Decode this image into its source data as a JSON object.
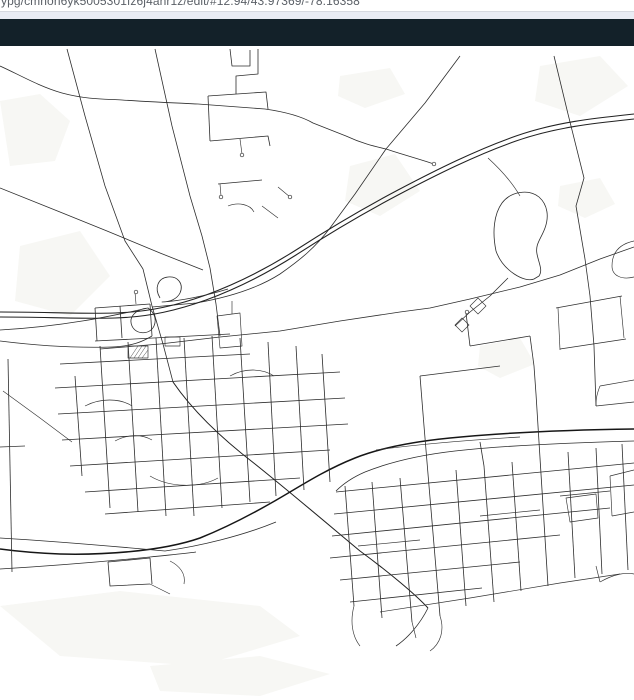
{
  "browser": {
    "url_text": "ypg/cmnon6yk5005301fz6j4ahr1z/edit/#12.94/43.97369/-78.16358"
  },
  "header": {
    "note": "empty dark toolbar"
  },
  "map": {
    "view": {
      "zoom": "12.94",
      "lat": "43.97369",
      "lng": "-78.16358"
    },
    "colors": {
      "background": "#ffffff",
      "patch": "#f7f7f4",
      "road": "#2d2d2d",
      "road_major": "#222222",
      "road_minor": "#333333",
      "railway": "#161616",
      "header_bg": "#132129",
      "chrome_strip": "#e9ecf4",
      "chrome_border": "#d6d9e0",
      "url_text_color": "#5b6067"
    },
    "patches": [
      "M0 55 L40 48 L70 75 L55 115 L10 120 Z",
      "M540 20 L600 10 L628 40 L580 70 L535 55 Z",
      "M20 200 L80 185 L110 230 L70 270 L15 255 Z",
      "M350 120 L395 108 L420 145 L380 170 L345 155 Z",
      "M0 560 L120 545 L260 560 L300 590 L200 620 L60 610 Z",
      "M480 300 L520 292 L535 318 L500 332 L478 320 Z",
      "M560 140 L600 132 L615 158 L585 172 L558 160 Z",
      "M150 620 L260 610 L330 628 L260 650 L160 645 Z",
      "M340 30 L390 22 L405 48 L365 62 L338 50 Z"
    ],
    "features": [
      {
        "name": "rural-road-north-a",
        "cls": "road",
        "d": "M67 3 L85 70 L105 140 L125 195 L143 223"
      },
      {
        "name": "burnham-through-interchange",
        "cls": "road",
        "d": "M143 223 L152 260 L163 298 L173 336"
      },
      {
        "name": "sweep-road-southeast",
        "cls": "major",
        "d": "M173 336 C195 368 225 395 255 418 C290 446 330 480 360 505 C390 527 416 549 428 562"
      },
      {
        "name": "rural-road-north-b",
        "cls": "road",
        "d": "M155 3 L172 80 L190 150 L202 190 L210 222"
      },
      {
        "name": "division-connector",
        "cls": "road",
        "d": "M210 222 L216 258 L220 290"
      },
      {
        "name": "top-curvy-road",
        "cls": "road",
        "d": "M0 20 C18 28 38 40 62 47 C88 54 108 53 122 54 C152 56 176 57 198 58 L265 63 C286 66 301 70 313 77 L346 90 C361 97 373 100 386 103"
      },
      {
        "name": "top-road-east-stub",
        "cls": "road",
        "d": "M386 103 C401 108 419 113 434 118"
      },
      {
        "name": "northeast-diagonal",
        "cls": "road",
        "d": "M460 10 L425 57 L386 103 L355 148 L330 182 C315 202 300 214 280 228 C255 244 225 252 196 257 L152 261"
      },
      {
        "name": "northwest-diagonal",
        "cls": "road",
        "d": "M0 142 L60 166 L107 185 L160 207 L203 224"
      },
      {
        "name": "cross-town-road",
        "cls": "road",
        "d": "M100 303 L160 298 L220 291 L280 285 L340 275 L400 266 L430 262 L470 253 L520 241 L560 229 L600 213 L634 201"
      },
      {
        "name": "east-rural-vertical",
        "cls": "road",
        "d": "M554 10 L568 68 L584 132 L576 160 L585 213"
      },
      {
        "name": "east-vertical-south",
        "cls": "road",
        "d": "M585 213 L590 250 L594 300 L596 360"
      },
      {
        "name": "highway-westbound",
        "cls": "major",
        "d": "M0 266 C45 266 80 268 115 267 C150 266 178 259 206 249 C236 238 266 223 296 204 C330 182 362 163 398 144 C436 124 476 104 516 90 C556 76 596 72 634 68"
      },
      {
        "name": "highway-eastbound",
        "cls": "major",
        "d": "M0 271 C45 271 80 273 115 272 C150 271 178 264 206 254 C236 243 266 228 296 209 C330 187 362 168 398 149 C436 129 476 109 516 95 C556 81 596 77 634 73"
      },
      {
        "name": "interchange-loop-north",
        "cls": "road",
        "d": "M160 252 C154 242 158 232 168 231 C178 230 184 238 180 247 C177 253 170 256 162 256 C180 255 205 250 228 243"
      },
      {
        "name": "interchange-loop-south",
        "cls": "road",
        "d": "M148 262 C136 263 128 271 132 280 C136 289 150 289 154 280 C157 273 154 266 148 262 C120 268 70 280 0 284"
      },
      {
        "name": "frontage-road-west",
        "cls": "road",
        "d": "M0 295 C40 300 80 302 112 301 C132 300 142 296 152 290"
      },
      {
        "name": "railway",
        "cls": "rail",
        "d": "M634 383 C560 384 500 387 450 392 C410 396 380 402 355 412 C330 422 310 434 290 446 C260 464 230 480 200 492 C160 506 100 509 60 508 C35 507 15 505 0 503"
      },
      {
        "name": "corridor-road-west-upper",
        "cls": "road",
        "d": "M0 492 C50 495 110 500 165 505 C200 500 242 490 276 476"
      },
      {
        "name": "corridor-road-west-lower",
        "cls": "road",
        "d": "M0 523 C50 520 100 516 150 511 C168 509 182 508 196 506"
      },
      {
        "name": "corridor-road-east",
        "cls": "road",
        "d": "M634 395 C560 397 500 400 455 405 C420 409 390 416 365 426 C351 432 343 438 336 445"
      },
      {
        "name": "rail-north-companion",
        "cls": "minor",
        "d": "M376 404 C420 398 470 394 520 391"
      },
      {
        "name": "pond-loop",
        "cls": "road",
        "d": "M496 205 C492 186 494 168 502 157 C511 145 529 143 539 151 C548 159 549 171 545 182 C541 193 535 198 537 208 C539 218 543 224 539 230 L534 233 C525 237 503 225 496 205 Z"
      },
      {
        "name": "pond-north-link",
        "cls": "minor",
        "d": "M520 150 C512 136 500 123 488 112"
      },
      {
        "name": "pond-west-street",
        "cls": "road",
        "d": "M508 232 L490 250 L470 266 L455 280"
      },
      {
        "name": "pond-west-pod-a",
        "cls": "minor",
        "d": "M478 252 L486 260 L478 268 L470 260 Z"
      },
      {
        "name": "pond-west-pod-b",
        "cls": "minor",
        "d": "M462 272 L469 279 L462 286 L455 279 Z"
      },
      {
        "name": "grid-street-h1",
        "cls": "road",
        "d": "M336 446 L634 417"
      },
      {
        "name": "grid-street-h2",
        "cls": "road",
        "d": "M334 468 L634 439"
      },
      {
        "name": "grid-street-h3",
        "cls": "road",
        "d": "M332 490 L610 462"
      },
      {
        "name": "grid-street-h4",
        "cls": "road",
        "d": "M330 512 L560 489"
      },
      {
        "name": "grid-street-h5",
        "cls": "road",
        "d": "M340 534 L520 516"
      },
      {
        "name": "grid-street-h6",
        "cls": "road",
        "d": "M350 556 L482 542"
      },
      {
        "name": "grid-street-v1",
        "cls": "road",
        "d": "M345 440 L354 560"
      },
      {
        "name": "grid-street-v2",
        "cls": "road",
        "d": "M372 436 L382 572"
      },
      {
        "name": "grid-street-v3",
        "cls": "road",
        "d": "M400 432 L412 576"
      },
      {
        "name": "grid-street-v4",
        "cls": "road",
        "d": "M428 428 L440 570"
      },
      {
        "name": "grid-street-v5",
        "cls": "road",
        "d": "M456 424 L466 560"
      },
      {
        "name": "grid-street-v6",
        "cls": "road",
        "d": "M484 420 L494 556"
      },
      {
        "name": "grid-street-v7",
        "cls": "road",
        "d": "M512 416 L521 545"
      },
      {
        "name": "grid-street-v8",
        "cls": "road",
        "d": "M540 412 L548 540"
      },
      {
        "name": "grid-street-v9",
        "cls": "road",
        "d": "M568 406 L575 532"
      },
      {
        "name": "grid-street-v10",
        "cls": "road",
        "d": "M596 402 L602 528"
      },
      {
        "name": "grid-street-v11",
        "cls": "road",
        "d": "M622 398 L628 524"
      },
      {
        "name": "grid-v-north-1",
        "cls": "road",
        "d": "M428 428 L424 380"
      },
      {
        "name": "grid-v-north-2",
        "cls": "road",
        "d": "M540 412 L536 348 L534 320"
      },
      {
        "name": "grid-v-north-3",
        "cls": "road",
        "d": "M484 420 L480 396"
      },
      {
        "name": "grid-south-edge",
        "cls": "minor",
        "d": "M380 566 L470 552 L560 537 L620 528"
      },
      {
        "name": "grid-south-stub-1",
        "cls": "minor",
        "d": "M354 560 C350 575 352 590 360 600"
      },
      {
        "name": "grid-south-stub-2",
        "cls": "minor",
        "d": "M412 576 L416 592"
      },
      {
        "name": "grid-south-stub-3",
        "cls": "minor",
        "d": "M440 570 C445 585 440 598 430 605"
      },
      {
        "name": "grid-inner-1",
        "cls": "minor",
        "d": "M358 500 L420 494"
      },
      {
        "name": "grid-inner-2",
        "cls": "minor",
        "d": "M480 470 L540 464"
      },
      {
        "name": "grid-inner-3",
        "cls": "minor",
        "d": "M560 450 L610 445"
      },
      {
        "name": "sweep-tail",
        "cls": "road",
        "d": "M428 562 C420 578 408 592 396 600"
      },
      {
        "name": "east-suburb-street",
        "cls": "road",
        "d": "M556 262 L622 250"
      },
      {
        "name": "east-suburb-street",
        "cls": "road",
        "d": "M560 303 L626 293"
      },
      {
        "name": "east-suburb-street",
        "cls": "minor",
        "d": "M558 262 L560 304"
      },
      {
        "name": "east-suburb-street",
        "cls": "minor",
        "d": "M620 250 L624 292"
      },
      {
        "name": "east-suburb-street",
        "cls": "minor",
        "d": "M600 340 L634 334"
      },
      {
        "name": "east-suburb-street",
        "cls": "minor",
        "d": "M596 360 L634 356"
      },
      {
        "name": "east-suburb-street",
        "cls": "minor",
        "d": "M600 340 C596 350 596 355 596 360"
      },
      {
        "name": "east-suburb-street",
        "cls": "minor",
        "d": "M610 430 L634 424"
      },
      {
        "name": "east-suburb-street",
        "cls": "minor",
        "d": "M612 470 L634 466"
      },
      {
        "name": "east-suburb-street",
        "cls": "minor",
        "d": "M610 430 L612 470"
      },
      {
        "name": "east-suburb-loop",
        "cls": "minor",
        "d": "M566 452 L596 448 L598 472 L570 476 Z"
      },
      {
        "name": "east-suburb-street",
        "cls": "minor",
        "d": "M600 536 C614 528 626 526 634 528"
      },
      {
        "name": "east-suburb-street",
        "cls": "minor",
        "d": "M600 536 L596 520"
      },
      {
        "name": "east-edge-hook",
        "cls": "minor",
        "d": "M634 195 C620 198 612 206 612 220 C612 230 622 234 634 231"
      },
      {
        "name": "subdivision-street",
        "cls": "road",
        "d": "M95 295 L230 288"
      },
      {
        "name": "subdivision-street",
        "cls": "road",
        "d": "M60 318 L250 308"
      },
      {
        "name": "subdivision-street",
        "cls": "road",
        "d": "M55 342 L340 326"
      },
      {
        "name": "subdivision-street",
        "cls": "road",
        "d": "M58 368 L345 352"
      },
      {
        "name": "subdivision-street",
        "cls": "road",
        "d": "M62 394 L348 378"
      },
      {
        "name": "subdivision-street",
        "cls": "road",
        "d": "M70 420 L330 404"
      },
      {
        "name": "subdivision-street",
        "cls": "road",
        "d": "M85 446 L300 432"
      },
      {
        "name": "subdivision-street",
        "cls": "road",
        "d": "M105 468 L270 456"
      },
      {
        "name": "subdivision-street",
        "cls": "road",
        "d": "M75 330 L82 430"
      },
      {
        "name": "subdivision-street",
        "cls": "road",
        "d": "M100 300 L110 462"
      },
      {
        "name": "subdivision-street",
        "cls": "road",
        "d": "M128 296 L138 466"
      },
      {
        "name": "subdivision-street",
        "cls": "road",
        "d": "M156 292 L166 470"
      },
      {
        "name": "subdivision-street",
        "cls": "road",
        "d": "M184 292 L194 470"
      },
      {
        "name": "subdivision-street",
        "cls": "road",
        "d": "M212 290 L222 462"
      },
      {
        "name": "subdivision-street",
        "cls": "road",
        "d": "M240 292 L250 456"
      },
      {
        "name": "subdivision-street",
        "cls": "road",
        "d": "M268 296 L276 450"
      },
      {
        "name": "subdivision-street",
        "cls": "road",
        "d": "M296 300 L304 444"
      },
      {
        "name": "subdivision-street",
        "cls": "road",
        "d": "M322 308 L330 436"
      },
      {
        "name": "subdivision-crescent",
        "cls": "minor",
        "d": "M85 360 C100 352 120 352 132 360"
      },
      {
        "name": "subdivision-crescent",
        "cls": "minor",
        "d": "M150 430 C170 442 200 442 218 432"
      },
      {
        "name": "subdivision-crescent",
        "cls": "minor",
        "d": "M230 330 C244 322 262 322 274 330"
      },
      {
        "name": "subdivision-crescent",
        "cls": "minor",
        "d": "M115 395 C128 388 142 388 152 394"
      },
      {
        "name": "school-building-outline",
        "cls": "minor",
        "d": "M128 300 L148 300 L148 312 L128 312 Z"
      },
      {
        "name": "school-building-hatch",
        "cls": "hatch",
        "d": "M130 312 L138 300 M134 312 L142 300 M138 312 L146 300 M142 312 L148 304"
      },
      {
        "name": "small-building-outline",
        "cls": "minor",
        "d": "M165 291 L180 291 L180 300 L165 300 Z"
      },
      {
        "name": "north-appendage-street",
        "cls": "road",
        "d": "M95 262 L150 258"
      },
      {
        "name": "north-appendage-street",
        "cls": "road",
        "d": "M95 262 L97 295"
      },
      {
        "name": "north-appendage-street",
        "cls": "road",
        "d": "M150 258 L152 290"
      },
      {
        "name": "north-appendage-street",
        "cls": "road",
        "d": "M120 260 L122 292"
      },
      {
        "name": "north-appendage-stub",
        "cls": "minor",
        "d": "M135 246 L136 258"
      },
      {
        "name": "top-cluster-street",
        "cls": "road",
        "d": "M230 3 L232 20 L250 20 L250 4"
      },
      {
        "name": "top-cluster-street",
        "cls": "road",
        "d": "M258 3 L258 28 L236 30 L236 48"
      },
      {
        "name": "top-cluster-street",
        "cls": "road",
        "d": "M208 50 L266 46 L268 63"
      },
      {
        "name": "top-cluster-street",
        "cls": "road",
        "d": "M208 50 L210 95"
      },
      {
        "name": "top-cluster-street",
        "cls": "road",
        "d": "M210 95 L268 90 L270 100"
      },
      {
        "name": "top-cluster-stub",
        "cls": "minor",
        "d": "M240 93 L242 108"
      },
      {
        "name": "top-cluster-street",
        "cls": "road",
        "d": "M218 138 L262 134"
      },
      {
        "name": "top-cluster-stub",
        "cls": "minor",
        "d": "M220 138 L221 150"
      },
      {
        "name": "top-cluster-hook",
        "cls": "minor",
        "d": "M228 160 C238 156 250 158 254 166"
      },
      {
        "name": "top-cluster-hook",
        "cls": "minor",
        "d": "M262 160 L278 172"
      },
      {
        "name": "top-cluster-stub",
        "cls": "minor",
        "d": "M278 141 L290 151"
      },
      {
        "name": "mid-connector",
        "cls": "road",
        "d": "M470 300 L530 290"
      },
      {
        "name": "mid-connector",
        "cls": "road",
        "d": "M470 300 L466 267"
      },
      {
        "name": "mid-connector",
        "cls": "road",
        "d": "M530 290 L534 320"
      },
      {
        "name": "mid-connector",
        "cls": "road",
        "d": "M420 330 L500 320"
      },
      {
        "name": "mid-connector",
        "cls": "road",
        "d": "M420 330 L424 380"
      },
      {
        "name": "west-edge-vertical",
        "cls": "road",
        "d": "M8 313 L12 526"
      },
      {
        "name": "west-edge-stub",
        "cls": "minor",
        "d": "M0 401 L25 400"
      },
      {
        "name": "west-diagonal",
        "cls": "minor",
        "d": "M3 345 L40 372 L72 396"
      },
      {
        "name": "bottom-left-street",
        "cls": "road",
        "d": "M108 516 L150 512"
      },
      {
        "name": "bottom-left-street",
        "cls": "road",
        "d": "M108 516 L110 540 L150 538"
      },
      {
        "name": "bottom-left-street",
        "cls": "road",
        "d": "M150 512 L152 538"
      },
      {
        "name": "bottom-left-stub",
        "cls": "minor",
        "d": "M150 538 L170 548"
      },
      {
        "name": "bottom-left-hook",
        "cls": "minor",
        "d": "M170 515 C180 520 186 528 184 538"
      },
      {
        "name": "interchange-east-block",
        "cls": "minor",
        "d": "M217 270 L240 267 L242 300 L220 302 Z"
      },
      {
        "name": "interchange-east-stub",
        "cls": "minor",
        "d": "M232 255 L232 268"
      }
    ],
    "cul_de_sacs": [
      [
        434,
        118
      ],
      [
        242,
        109
      ],
      [
        136,
        246
      ],
      [
        290,
        151
      ],
      [
        221,
        151
      ],
      [
        467,
        266
      ]
    ]
  }
}
